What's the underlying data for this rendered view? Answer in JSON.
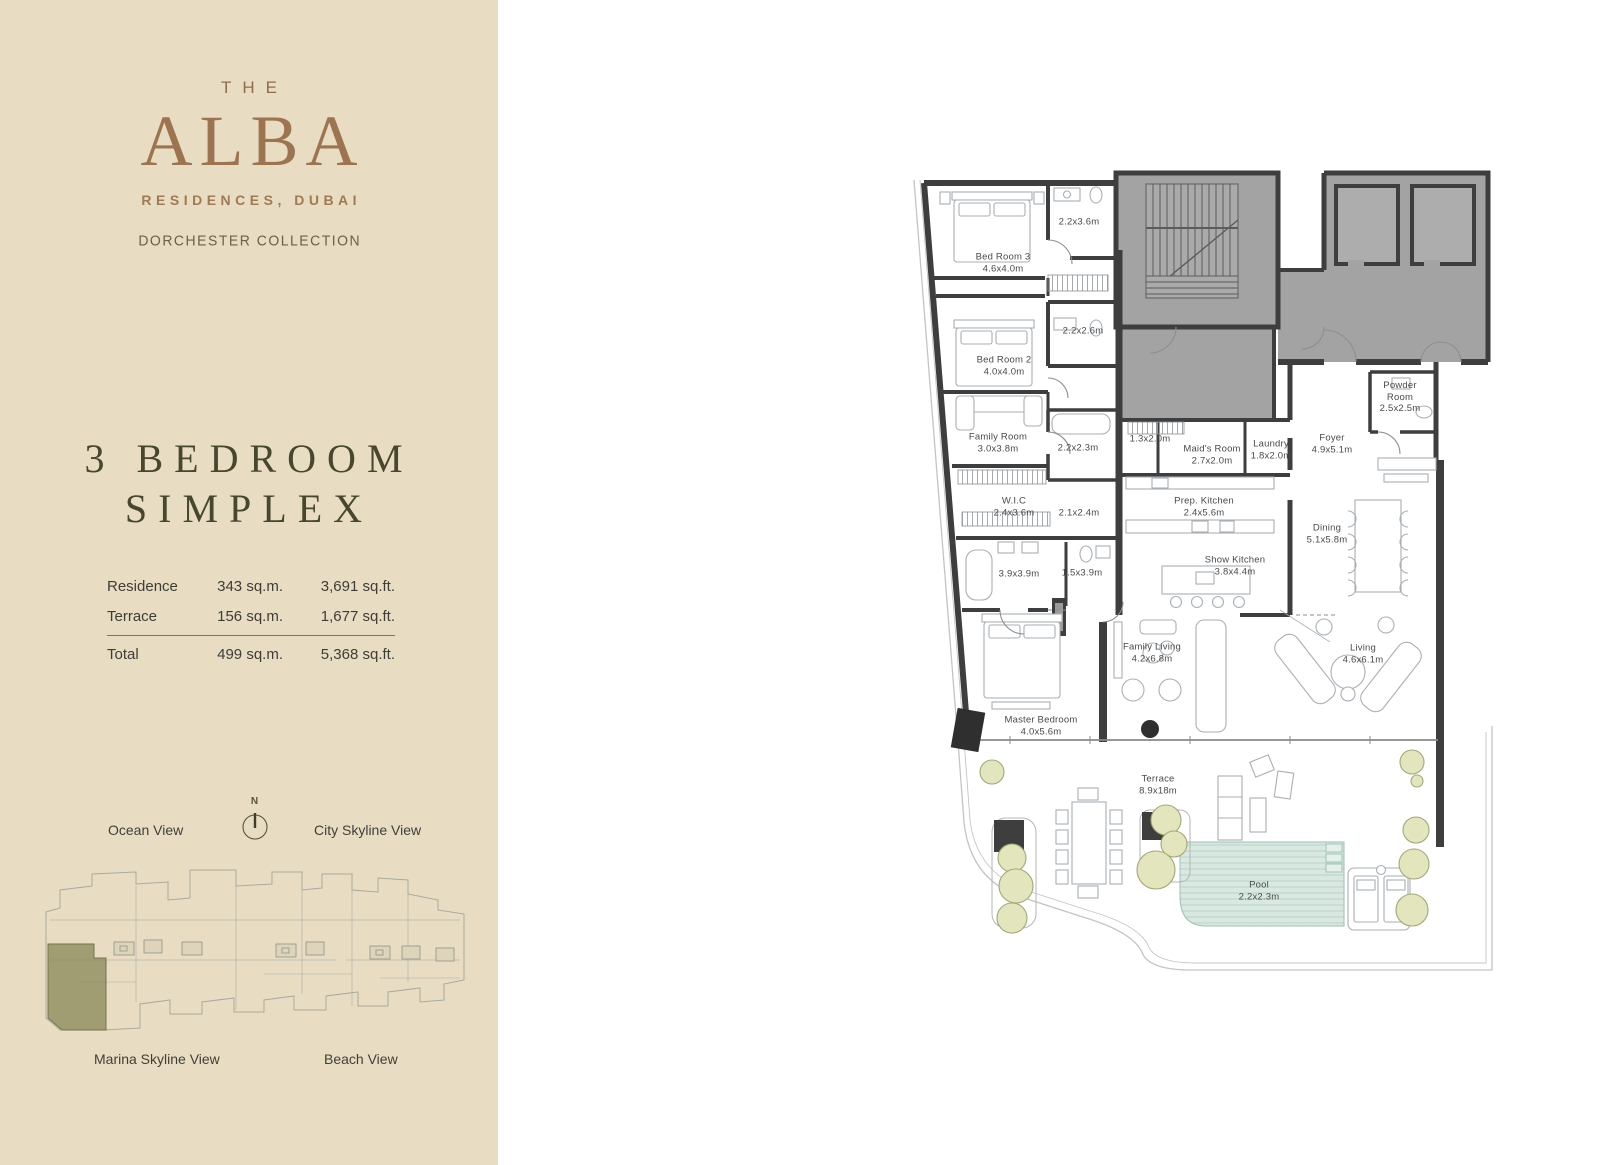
{
  "brand": {
    "the": "THE",
    "name": "ALBA",
    "subtitle": "RESIDENCES, DUBAI",
    "collection": "DORCHESTER COLLECTION"
  },
  "unit": {
    "title_line1": "3 BEDROOM",
    "title_line2": "SIMPLEX",
    "area_rows": [
      {
        "label": "Residence",
        "sqm": "343 sq.m.",
        "sqft": "3,691 sq.ft."
      },
      {
        "label": "Terrace",
        "sqm": "156 sq.m.",
        "sqft": "1,677 sq.ft."
      },
      {
        "label": "Total",
        "sqm": "499 sq.m.",
        "sqft": "5,368 sq.ft."
      }
    ]
  },
  "orientation": {
    "compass_letter": "N",
    "view_top_left": "Ocean View",
    "view_top_right": "City Skyline View",
    "view_bottom_left": "Marina Skyline View",
    "view_bottom_right": "Beach View"
  },
  "colors": {
    "sidebar-bg": "#e8ddc3",
    "brand": "#9c7450",
    "brand-dark": "#6e5f46",
    "heading": "#47472f",
    "text": "#3d3d35",
    "wall": "#3e3e3e",
    "core": "#a3a3a3",
    "label": "#4a4a4a",
    "map-line": "#a9aa9e",
    "map-highlight": "#8d8d5f",
    "pool": "#d9e9e1",
    "tree": "#e3e6bd"
  },
  "floor_plan": {
    "rooms": [
      {
        "name": "Bed Room 3",
        "dims": "4.6x4.0m",
        "x": 103,
        "y": 93
      },
      {
        "name": "",
        "dims": "2.2x3.6m",
        "x": 179,
        "y": 52
      },
      {
        "name": "Bed Room 2",
        "dims": "4.0x4.0m",
        "x": 104,
        "y": 196
      },
      {
        "name": "",
        "dims": "2.2x2.6m",
        "x": 183,
        "y": 161
      },
      {
        "name": "Family Room",
        "dims": "3.0x3.8m",
        "x": 98,
        "y": 273
      },
      {
        "name": "",
        "dims": "2.2x2.3m",
        "x": 178,
        "y": 278
      },
      {
        "name": "W.I.C",
        "dims": "2.4x3.6m",
        "x": 114,
        "y": 337
      },
      {
        "name": "",
        "dims": "2.1x2.4m",
        "x": 179,
        "y": 343
      },
      {
        "name": "",
        "dims": "3.9x3.9m",
        "x": 119,
        "y": 404
      },
      {
        "name": "",
        "dims": "1.5x3.9m",
        "x": 182,
        "y": 403
      },
      {
        "name": "",
        "dims": "1.3x2.0m",
        "x": 250,
        "y": 269
      },
      {
        "name": "Maid's Room",
        "dims": "2.7x2.0m",
        "x": 312,
        "y": 285
      },
      {
        "name": "Laundry",
        "dims": "1.8x2.0m",
        "x": 371,
        "y": 280
      },
      {
        "name": "Foyer",
        "dims": "4.9x5.1m",
        "x": 432,
        "y": 274
      },
      {
        "name": "Powder Room",
        "dims": "2.5x2.5m",
        "x": 500,
        "y": 227,
        "w": 56
      },
      {
        "name": "Prep. Kitchen",
        "dims": "2.4x5.6m",
        "x": 304,
        "y": 337
      },
      {
        "name": "Show Kitchen",
        "dims": "3.8x4.4m",
        "x": 335,
        "y": 396
      },
      {
        "name": "Dining",
        "dims": "5.1x5.8m",
        "x": 427,
        "y": 364
      },
      {
        "name": "Family Living",
        "dims": "4.2x6.8m",
        "x": 252,
        "y": 483
      },
      {
        "name": "Living",
        "dims": "4.6x6.1m",
        "x": 463,
        "y": 484
      },
      {
        "name": "Master Bedroom",
        "dims": "4.0x5.6m",
        "x": 141,
        "y": 556
      },
      {
        "name": "Terrace",
        "dims": "8.9x18m",
        "x": 258,
        "y": 615
      },
      {
        "name": "Pool",
        "dims": "2.2x2.3m",
        "x": 359,
        "y": 721
      }
    ]
  }
}
